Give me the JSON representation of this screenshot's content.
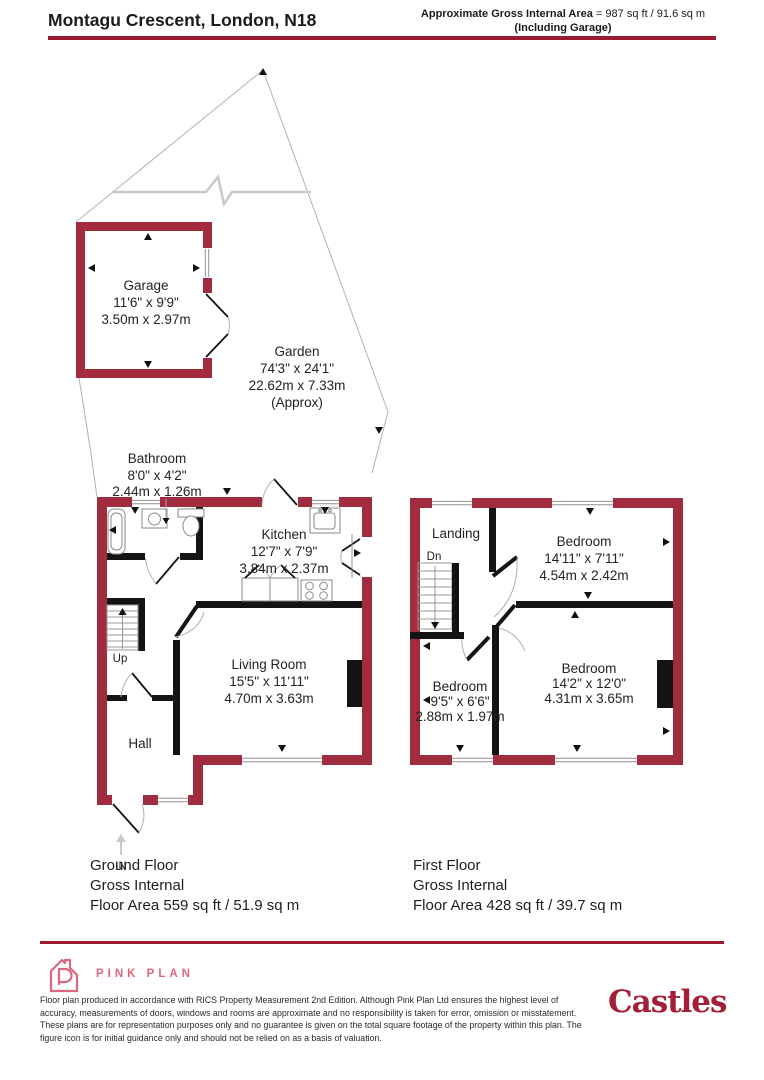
{
  "header": {
    "title": "Montagu Crescent, London, N18",
    "area_label": "Approximate Gross Internal Area",
    "area_value": " = 987 sq ft / 91.6 sq m",
    "area_note": "(Including Garage)"
  },
  "plan": {
    "garage": {
      "name": "Garage",
      "imperial": "11'6\" x 9'9\"",
      "metric": "3.50m x 2.97m"
    },
    "garden": {
      "name": "Garden",
      "imperial": "74'3\" x 24'1\"",
      "metric": "22.62m x 7.33m",
      "note": "(Approx)"
    },
    "bathroom": {
      "name": "Bathroom",
      "imperial": "8'0\" x 4'2\"",
      "metric": "2.44m x 1.26m"
    },
    "kitchen": {
      "name": "Kitchen",
      "imperial": "12'7\" x 7'9\"",
      "metric": "3.84m x 2.37m"
    },
    "living_room": {
      "name": "Living Room",
      "imperial": "15'5\" x 11'11\"",
      "metric": "4.70m x 3.63m"
    },
    "hall": {
      "name": "Hall"
    },
    "landing": {
      "name": "Landing"
    },
    "bedroom_top": {
      "name": "Bedroom",
      "imperial": "14'11\" x 7'11\"",
      "metric": "4.54m x 2.42m"
    },
    "bedroom_small": {
      "name": "Bedroom",
      "imperial": "9'5\" x 6'6\"",
      "metric": "2.88m x 1.97m"
    },
    "bedroom_main": {
      "name": "Bedroom",
      "imperial": "14'2\" x 12'0\"",
      "metric": "4.31m x 3.65m"
    },
    "stairs_up": "Up",
    "stairs_dn": "Dn",
    "entrance": "IN"
  },
  "captions": {
    "ground_floor": {
      "title": "Ground Floor",
      "subtitle": "Gross Internal",
      "area": "Floor Area 559 sq ft / 51.9 sq m"
    },
    "first_floor": {
      "title": "First Floor",
      "subtitle": "Gross Internal",
      "area": "Floor Area 428 sq ft / 39.7 sq m"
    }
  },
  "footer": {
    "producer": "PINK PLAN",
    "disclaimer": "Floor plan produced in accordance with RICS Property Measurement 2nd Edition. Although Pink Plan Ltd ensures the highest level of accuracy, measurements of doors, windows and rooms are approximate and no responsibility is taken for error, omission or misstatement. These plans are for representation purposes only and no guarantee is given on the total square footage of the property within this plan. The figure icon is for initial guidance only and should not be relied on as a basis of valuation.",
    "agent": "Castles"
  },
  "colors": {
    "wall": "#A12C3F",
    "rule": "#9A1B2F",
    "pink": "#DC6880",
    "agent_red": "#A31F36"
  }
}
